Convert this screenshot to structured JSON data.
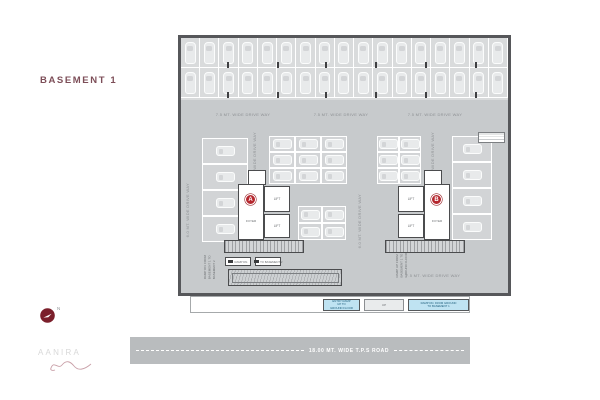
{
  "title": "BASEMENT 1",
  "logo": {
    "name": "AANIRA"
  },
  "north_label": "N",
  "road_label": "18.00 MT. WIDE T.P.S ROAD",
  "drive_labels": {
    "top_left": "7.5 MT. WIDE DRIVE WAY",
    "top_center": "7.5 MT. WIDE DRIVE WAY",
    "top_right": "7.5 MT. WIDE DRIVE WAY",
    "left_side": "6.0 MT. WIDE DRIVE WAY",
    "center": "6.0 MT. WIDE DRIVE WAY",
    "right_side": "6.0 MT. WIDE DRIVE WAY",
    "core_a_lane": "4.5 MT. WIDE DRIVE WAY",
    "core_b_lane": "4.5 MT. WIDE DRIVE WAY",
    "bottom": "7.5 MT. WIDE DRIVE WAY"
  },
  "core_a": {
    "marker": "A",
    "foyer": "FOYER",
    "lift_1": "LIFT",
    "lift_2": "LIFT"
  },
  "core_b": {
    "marker": "B",
    "foyer": "FOYER",
    "lift_1": "LIFT",
    "lift_2": "LIFT"
  },
  "ramp": {
    "left_note_l1": "RAMP DN. FROM",
    "left_note_l2": "BASEMENT 1 TO",
    "left_note_l3": "BASEMENT 2",
    "right_note_l1": "RAMP UP FROM",
    "right_note_l2": "BASEMENT 1 TO",
    "right_note_l3": "GROUND FLOOR",
    "tag_1": "RAMP DN.",
    "tag_2": "TO BASEMENT 2",
    "entry_box_l1": "ENTRY RAMP",
    "entry_box_l2": "UP TO",
    "entry_box_l3": "GROUND FLOOR",
    "mid_box": "UP",
    "exit_box_l1": "RAMP DN. FROM GROUND",
    "exit_box_l2": "TO BASEMENT 1"
  },
  "colors": {
    "accent_red": "#b5272e",
    "title_maroon": "#7d4e58",
    "plan_bg": "#c7cacc",
    "stall_bg": "#d9dbdc",
    "ramp_blue": "#bfe3f2",
    "road_gray": "#b9bcbe",
    "wall_dark": "#56575a"
  }
}
